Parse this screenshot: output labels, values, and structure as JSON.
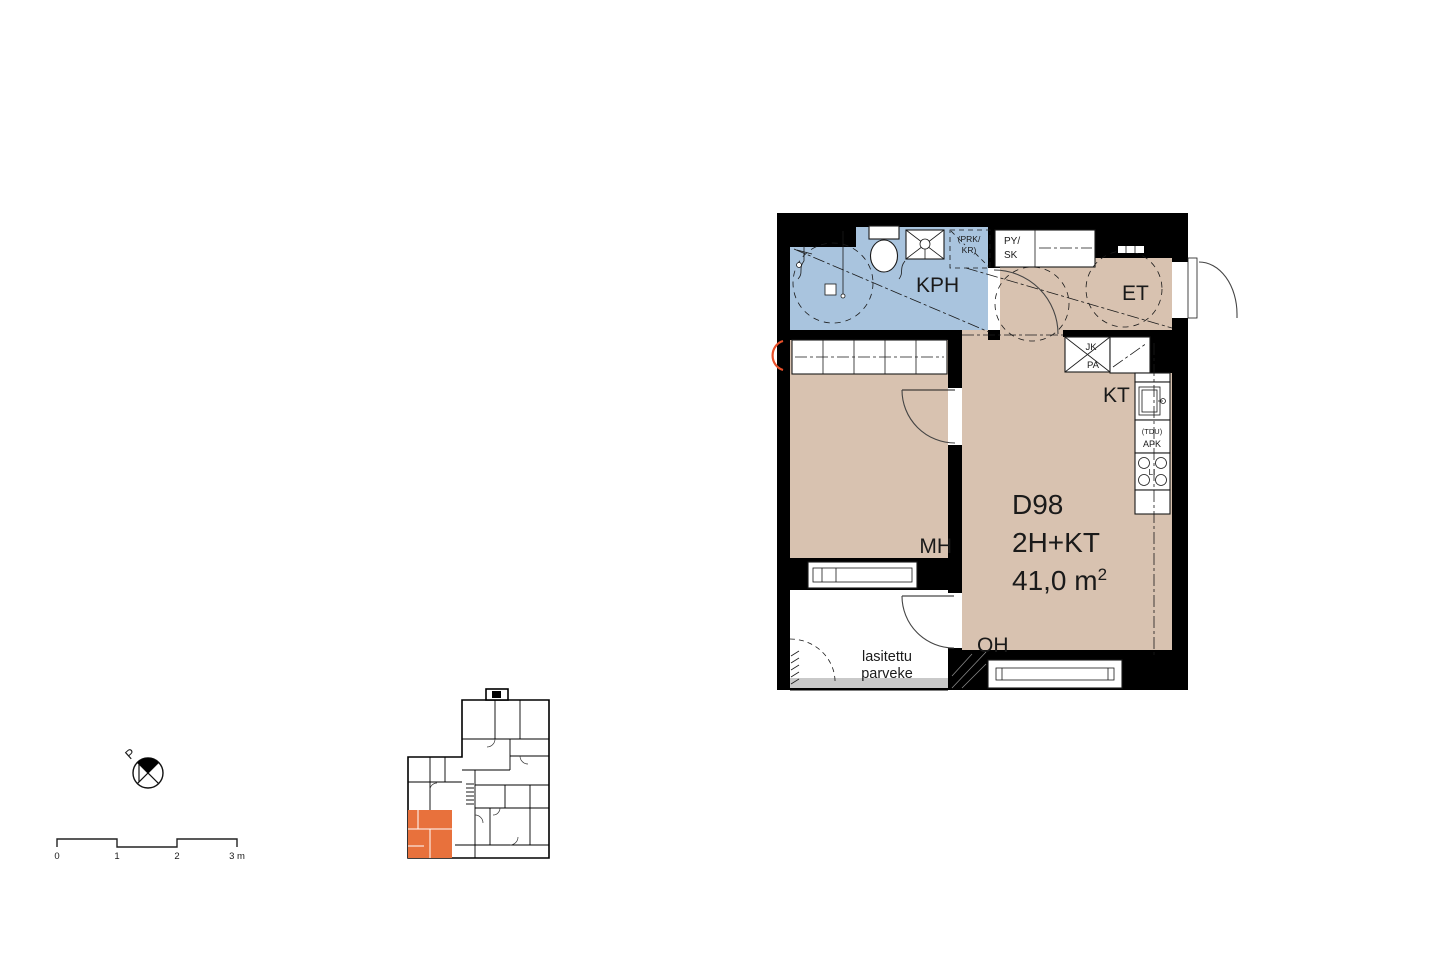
{
  "plan": {
    "unit": {
      "id": "D98",
      "type": "2H+KT",
      "area": "41,0 m",
      "area_exp": "2"
    },
    "rooms": {
      "bathroom": "KPH",
      "entry": "ET",
      "kitchen": "KT",
      "bedroom": "MH",
      "living": "OH",
      "balcony_line1": "lasitettu",
      "balcony_line2": "parveke"
    },
    "fixtures": {
      "washer_reserve_line1": "(PRK/",
      "washer_reserve_line2": "KR)",
      "closet_line1": "PY/",
      "closet_line2": "SK",
      "fridge": "JK",
      "freezer": "PA",
      "dishwasher_reserve": "(TDU)",
      "dishwasher": "APK",
      "stove": "LI"
    },
    "colors": {
      "floor": "#d8c2b0",
      "wet_room": "#a9c4de",
      "wall": "#000000",
      "highlight": "#e8713c",
      "balcony_edge": "#c9c9c9",
      "annotation": "#e8502a"
    }
  },
  "north_arrow": {
    "label": "P"
  },
  "scale_bar": {
    "labels": [
      "0",
      "1",
      "2",
      "3 m"
    ]
  }
}
